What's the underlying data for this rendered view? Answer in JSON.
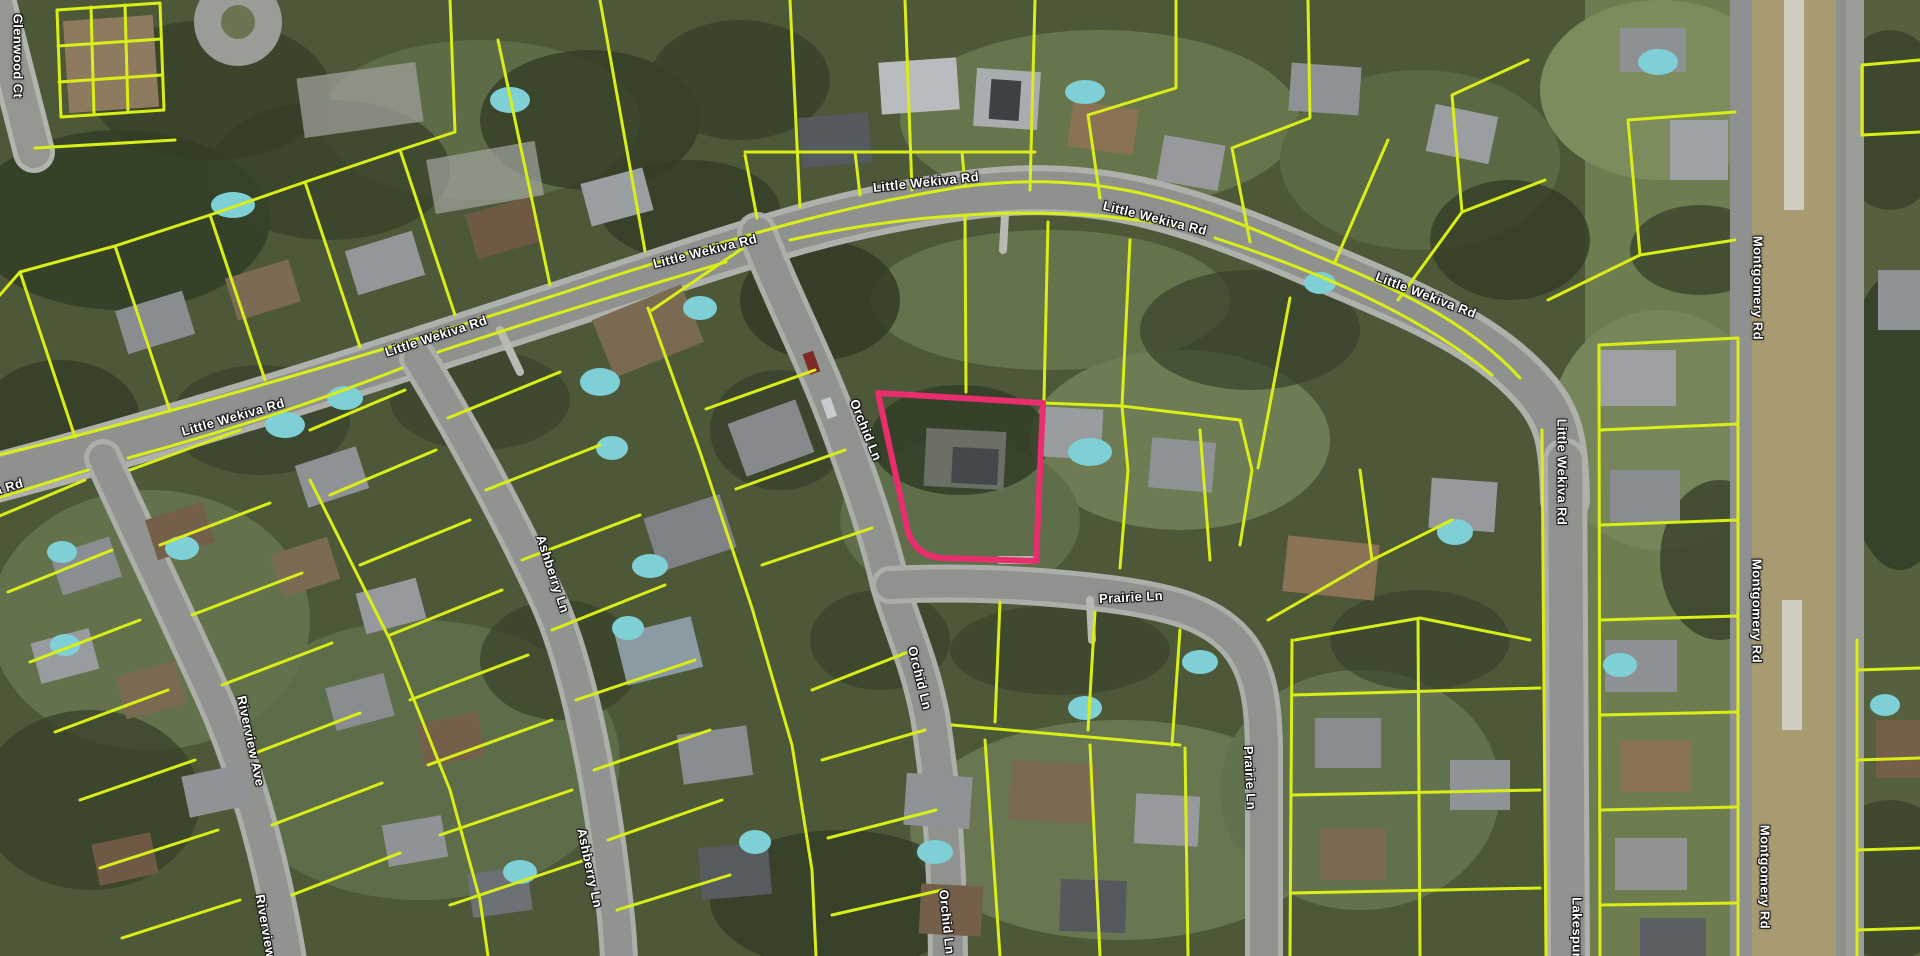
{
  "title": "Aerial parcel map with highlighted parcel",
  "map": {
    "colors": {
      "parcel_line": "#d8ee16",
      "highlight": "#e92e6d",
      "label_text": "#ffffff",
      "label_halo": "#161616"
    },
    "street_labels": [
      {
        "text": "Glenwood Ct",
        "x": 18,
        "y": 56,
        "rot": 90
      },
      {
        "text": "Little Wekiva Rd",
        "x": -28,
        "y": 498,
        "rot": -17
      },
      {
        "text": "Little Wekiva Rd",
        "x": 233,
        "y": 417,
        "rot": -16
      },
      {
        "text": "Little Wekiva Rd",
        "x": 436,
        "y": 336,
        "rot": -18
      },
      {
        "text": "Little Wekiva Rd",
        "x": 705,
        "y": 251,
        "rot": -14
      },
      {
        "text": "Little Wekiva Rd",
        "x": 926,
        "y": 182,
        "rot": -6
      },
      {
        "text": "Little Wekiva Rd",
        "x": 1155,
        "y": 218,
        "rot": 14
      },
      {
        "text": "Little Wekiva Rd",
        "x": 1426,
        "y": 295,
        "rot": 21
      },
      {
        "text": "Little Wekiva Rd",
        "x": 1562,
        "y": 472,
        "rot": 90
      },
      {
        "text": "Orchid Ln",
        "x": 866,
        "y": 430,
        "rot": 68
      },
      {
        "text": "Orchid Ln",
        "x": 920,
        "y": 678,
        "rot": 76
      },
      {
        "text": "Orchid Ln",
        "x": 947,
        "y": 922,
        "rot": 84
      },
      {
        "text": "Prairie Ln",
        "x": 1131,
        "y": 597,
        "rot": -3
      },
      {
        "text": "Prairie Ln",
        "x": 1250,
        "y": 778,
        "rot": 87
      },
      {
        "text": "Ashberry Ln",
        "x": 553,
        "y": 574,
        "rot": 72
      },
      {
        "text": "Ashberry Ln",
        "x": 590,
        "y": 868,
        "rot": 78
      },
      {
        "text": "Riverview Ave",
        "x": 251,
        "y": 741,
        "rot": 78
      },
      {
        "text": "Riverview Ave",
        "x": 268,
        "y": 940,
        "rot": 80
      },
      {
        "text": "Montgomery Rd",
        "x": 1758,
        "y": 288,
        "rot": 90
      },
      {
        "text": "Montgomery Rd",
        "x": 1757,
        "y": 611,
        "rot": 90
      },
      {
        "text": "Montgomery Rd",
        "x": 1765,
        "y": 877,
        "rot": 90
      },
      {
        "text": "Lakespur Ln",
        "x": 1577,
        "y": 938,
        "rot": 90
      }
    ],
    "highlighted_parcel": {
      "path": "M878,393 L1043,403 L1036,561 L942,558 Q916,556 908,532 Z"
    }
  }
}
